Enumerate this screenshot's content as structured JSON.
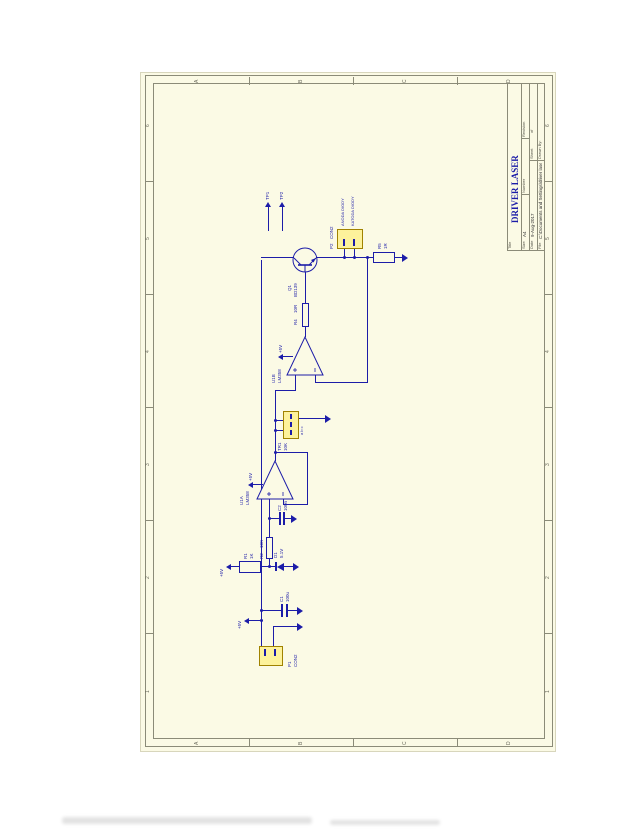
{
  "document": {
    "type": "schematic-scan",
    "sheet_color": "#fbfae5",
    "wire_color": "#1c1ca8",
    "connector_fill": "#fdf29b"
  },
  "grid": {
    "columns": [
      "1",
      "2",
      "3",
      "4",
      "5",
      "6"
    ],
    "rows": [
      "A",
      "B",
      "C",
      "D"
    ]
  },
  "title_block": {
    "title_label": "Title",
    "title": "DRIVER LASER",
    "size_label": "Size",
    "size": "A4",
    "number_label": "Number",
    "revision_label": "Revision",
    "date_label": "Date",
    "date": "9-Aug-2017",
    "sheet_label": "Sheet",
    "sheet_of": "of",
    "file_label": "File",
    "file": "C:\\Documents and Settings\\driver laser.ddb",
    "drawn_label": "Drawn By:"
  },
  "power": {
    "vcc": "+5V"
  },
  "components": {
    "con1": {
      "designator": "P1",
      "value": "CON2"
    },
    "c1": {
      "designator": "C1",
      "value": "100u"
    },
    "r1": {
      "designator": "R1",
      "value": "1K"
    },
    "d1": {
      "designator": "D1",
      "value": "5.1V"
    },
    "r2": {
      "designator": "R2",
      "value": "10K"
    },
    "c2": {
      "designator": "C2",
      "value": "100n"
    },
    "u1a": {
      "designator": "U1A",
      "value": "LM358"
    },
    "tr1": {
      "designator": "TR1",
      "value": "10K",
      "pins": "a b c"
    },
    "u1b": {
      "designator": "U1B",
      "value": "LM358"
    },
    "r4": {
      "designator": "R4",
      "value": "10R"
    },
    "q1": {
      "designator": "Q1",
      "value": "BD139"
    },
    "r5": {
      "designator": "R5",
      "value": "1R"
    },
    "con2": {
      "designator": "P2",
      "value": "CON2",
      "pin1_label": "ANODA DIODY",
      "pin2_label": "KATODA DIODY"
    },
    "tp1": {
      "designator": "TP1"
    },
    "tp2": {
      "designator": "TP2"
    }
  }
}
